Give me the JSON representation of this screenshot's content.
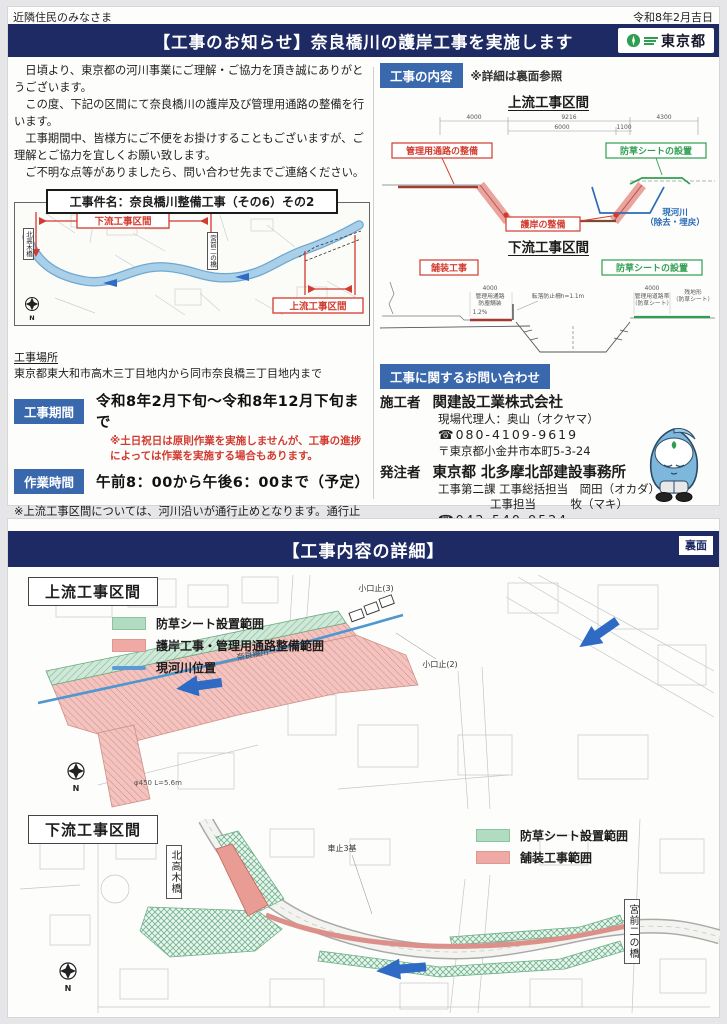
{
  "colors": {
    "navy": "#1e2a63",
    "badge_blue": "#3a68ad",
    "red": "#d23b2f",
    "green": "#2f9e50",
    "river": "#8fbede",
    "arrow": "#2f6bc4"
  },
  "page1": {
    "audience": "近隣住民のみなさま",
    "date": "令和8年2月吉日",
    "banner_title": "【工事のお知らせ】奈良橋川の護岸工事を実施します",
    "logo_text": "東京都",
    "greeting": [
      "　日頃より、東京都の河川事業にご理解・ご協力を頂き誠にありがとうございます。",
      "　この度、下記の区間にて奈良橋川の護岸及び管理用通路の整備を行います。",
      "　工事期間中、皆様方にご不便をお掛けすることもございますが、ご理解とご協力を宜しくお願い致します。",
      "　ご不明な点等がありましたら、問い合わせ先までご連絡ください。"
    ],
    "project_title": "工事件名：奈良橋川整備工事（その6）その2",
    "overview_map": {
      "downstream_label": "下流工事区間",
      "upstream_label": "上流工事区間",
      "bridge_left": "北高木橋",
      "bridge_mid": "宮前二の橋",
      "compass": "N"
    },
    "location_heading": "工事場所",
    "location_value": "東京都東大和市高木三丁目地内から同市奈良橋三丁目地内まで",
    "period_badge": "工事期間",
    "period_value": "令和8年2月下旬～令和8年12月下旬まで",
    "period_note_1": "※土日祝日は原則作業を実施しませんが、工事の進捗",
    "period_note_2": "によっては作業を実施する場合もあります。",
    "hours_badge": "作業時間",
    "hours_value": "午前8：00から午後6：00まで（予定）",
    "closure_note": "※上流工事区間については、河川沿いが通行止めとなります。通行止め期間及び迂回路につきましては、現地に掲示する等周知致します。出入口には交通誘導員を配置し、安全確保に努めてまいります。",
    "content_badge": "工事の内容",
    "content_note": "※詳細は裏面参照",
    "xsec_upstream": {
      "title": "上流工事区間",
      "dim_4000": "4000",
      "dim_9216": "9216",
      "dim_4300": "4300",
      "dim_6000": "6000",
      "dim_1100": "1100",
      "label_road": "管理用通路の整備",
      "label_sheet": "防草シートの設置",
      "label_bank": "護岸の整備",
      "label_river_1": "現河川",
      "label_river_2": "（除去・埋戻）"
    },
    "xsec_downstream": {
      "title": "下流工事区間",
      "label_paving": "舗装工事",
      "label_sheet": "防草シートの設置",
      "dim_4000_l": "4000",
      "small_road": "管理用通路",
      "small_paving": "防塵舗装",
      "small_fence": "転落防止柵h=1.1m",
      "small_slope": "1.2%",
      "dim_4000_r": "4000",
      "small_strip": "管理用道路帯",
      "small_strip2": "（防草シート）",
      "small_rem": "残地形",
      "small_rem2": "（防草シート）"
    },
    "contact": {
      "badge": "工事に関するお問い合わせ",
      "contractor_label": "施工者",
      "contractor_name": "関建設工業株式会社",
      "contractor_rep": "現場代理人：奥山（オクヤマ）",
      "contractor_tel": "☎080-4109-9619",
      "contractor_addr": "〒東京都小金井市本町5-3-24",
      "client_label": "発注者",
      "client_name": "東京都 北多摩北部建設事務所",
      "client_line1": "工事第二課 工事総括担当　岡田（オカダ）",
      "client_line2": "工事担当　　　牧（マキ）",
      "client_tel": "☎042-540-9524",
      "client_addr": "〒東京都立川市柴崎町2-15-19"
    }
  },
  "page2": {
    "banner_title": "【工事内容の詳細】",
    "page_label": "裏面",
    "upstream": {
      "title": "上流工事区間",
      "legend": [
        {
          "label": "防草シート設置範囲"
        },
        {
          "label": "護岸工事・管理用通路整備範囲"
        },
        {
          "label": "現河川位置"
        }
      ],
      "map_label_1": "小口止(3)",
      "map_label_2": "小口止(2)",
      "map_label_3": "奈良橋川",
      "map_label_4": "φ450 L=5.6m",
      "compass": "N"
    },
    "downstream": {
      "title": "下流工事区間",
      "legend": [
        {
          "label": "防草シート設置範囲"
        },
        {
          "label": "舗装工事範囲"
        }
      ],
      "bridge_left": "北高木橋",
      "bridge_right": "宮前二の橋",
      "map_label_1": "車止3基",
      "compass": "N"
    }
  }
}
